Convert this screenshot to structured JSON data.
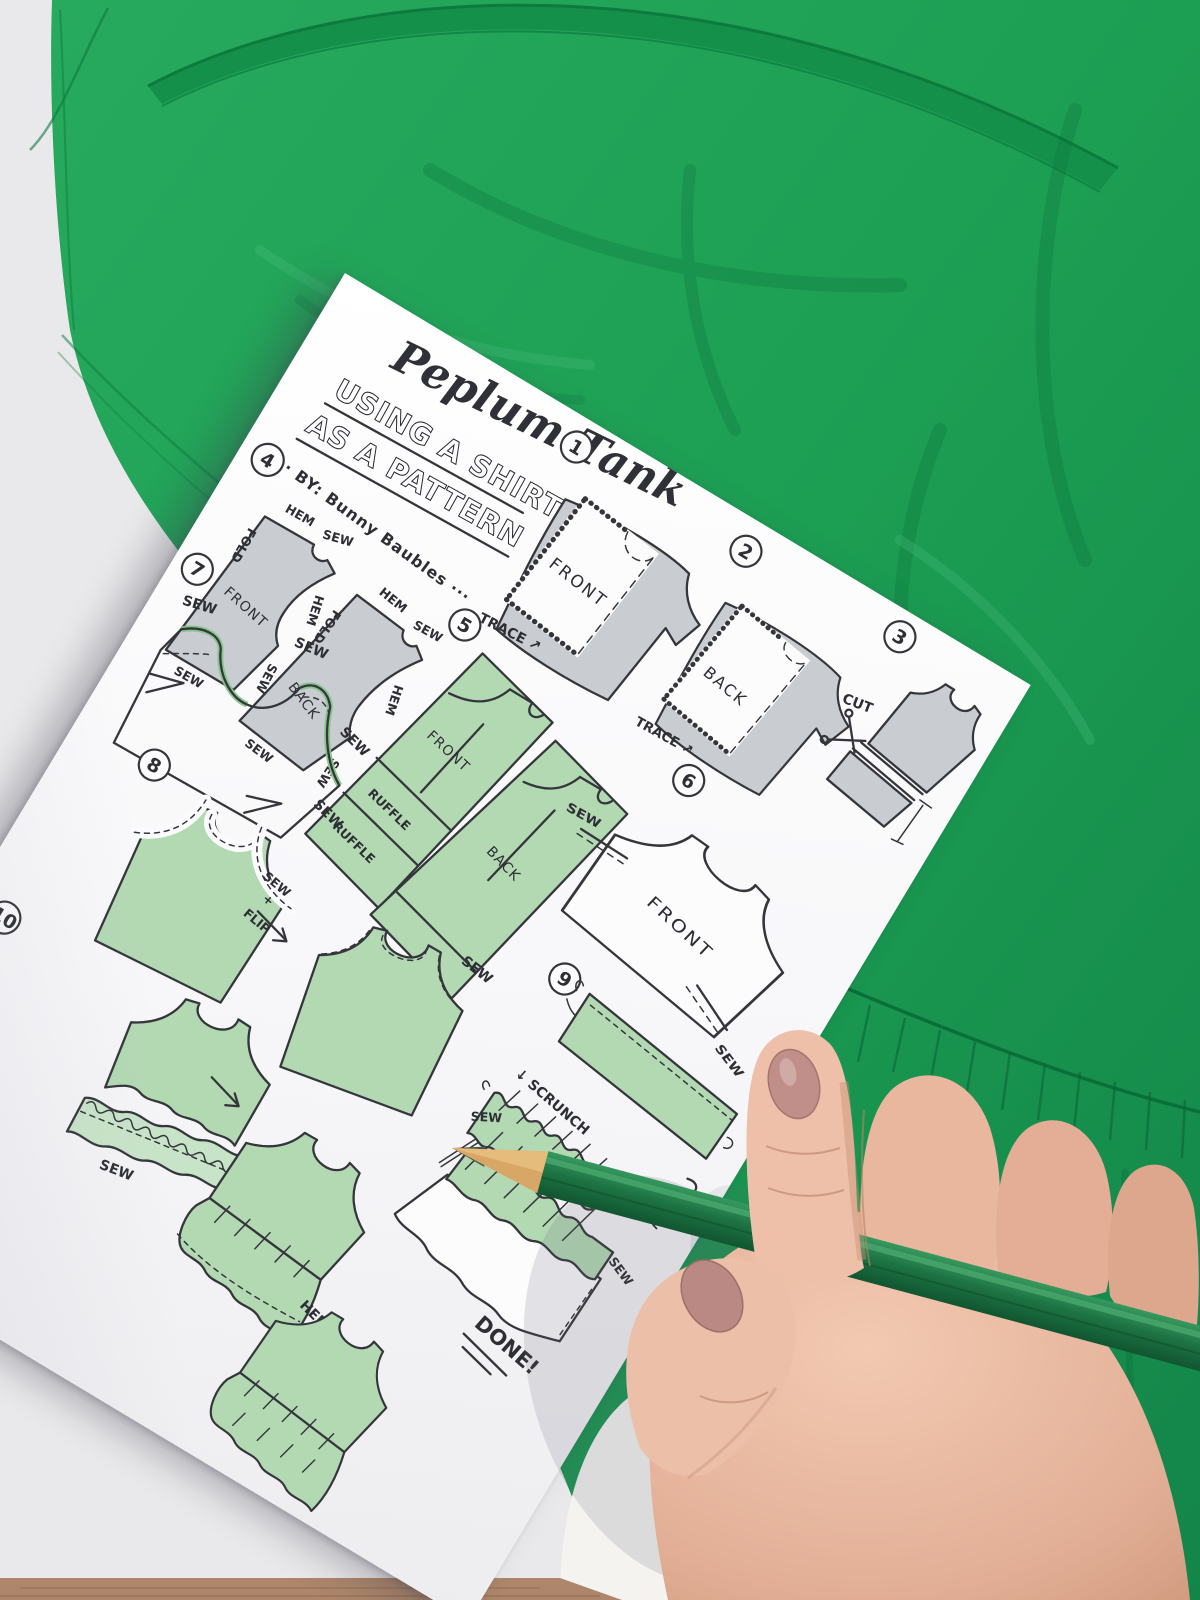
{
  "colors": {
    "background": "#e9e9eb",
    "shirt_green": "#1c9e53",
    "shirt_dark": "#0d7a3e",
    "paper_white": "#fbfbfd",
    "crayon_green": "#b3d9b3",
    "crayon_gray": "#c9cdd2",
    "ink": "#35363c",
    "pencil_green": "#1d7343",
    "skin": "#eabca6",
    "floor_brown": "#ad866b"
  },
  "paper": {
    "title": "Peplum Tank",
    "subtitle_line1": "USING A SHIRT",
    "subtitle_line2": "AS A PATTERN",
    "byline": "··· BY: Bunny Baubles ···",
    "labels": {
      "front": "FRONT",
      "back": "BACK",
      "trace": "TRACE ↗",
      "cut": "CUT",
      "cut_arrow": "CUT ↗",
      "sew": "SEW",
      "plus": "+",
      "flip": "FLIP",
      "hem": "HEM",
      "fold": "FOLD",
      "ruffle": "RUFFLE",
      "scrunch": "↓ SCRUNCH",
      "pull": "PULL",
      "done": "DONE!"
    },
    "steps": [
      {
        "num": "1"
      },
      {
        "num": "2"
      },
      {
        "num": "3"
      },
      {
        "num": "4"
      },
      {
        "num": "5"
      },
      {
        "num": "6"
      },
      {
        "num": "7"
      },
      {
        "num": "8"
      },
      {
        "num": "9"
      },
      {
        "num": "10"
      }
    ]
  }
}
